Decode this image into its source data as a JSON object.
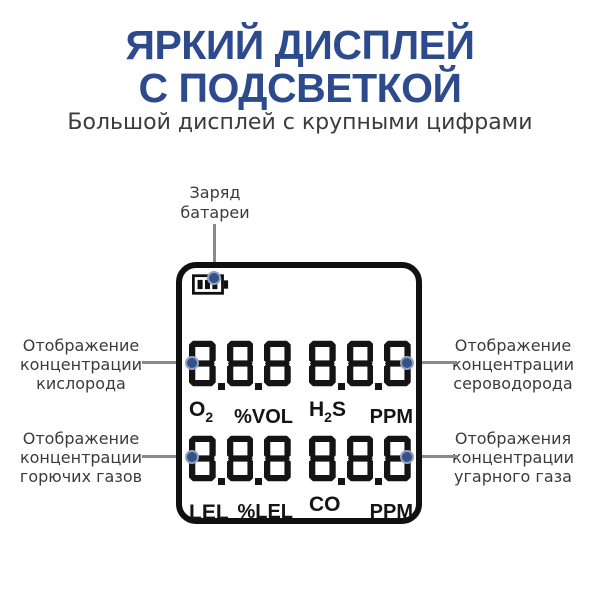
{
  "title": {
    "line1": "ЯРКИЙ ДИСПЛЕЙ",
    "line2": "С ПОДСВЕТКОЙ"
  },
  "subtitle": "Большой дисплей с крупными цифрами",
  "callouts": {
    "battery": [
      "Заряд",
      "батареи"
    ],
    "left_top": [
      "Отображение",
      "концентрации",
      "кислорода"
    ],
    "left_bottom": [
      "Отображение",
      "концентрации",
      "горючих газов"
    ],
    "right_top": [
      "Отображение",
      "концентрации",
      "сероводорода"
    ],
    "right_bottom": [
      "Отображения",
      "концентрации",
      "угарного газа"
    ]
  },
  "display": {
    "battery_icon": "battery-3-bars",
    "readouts": [
      {
        "id": "o2",
        "value": "8.8.8",
        "gas_pre": "O",
        "gas_sub": "2",
        "gas_post": "",
        "unit": "%VOL"
      },
      {
        "id": "h2s",
        "value": "8.8.8",
        "gas_pre": "H",
        "gas_sub": "2",
        "gas_post": "S",
        "unit": "PPM"
      },
      {
        "id": "lel",
        "value": "8.8.8",
        "gas_pre": "LEL",
        "gas_sub": "",
        "gas_post": "",
        "unit": "%LEL"
      },
      {
        "id": "co",
        "value": "8.8.8",
        "gas_pre": "CO",
        "gas_sub": "",
        "gas_post": "",
        "unit": "PPM"
      }
    ]
  },
  "colors": {
    "title_blue": "#2c4a8c",
    "label_gray": "#3b3b3b",
    "connector_gray": "#8a8a8a",
    "dot_blue": "#33518a",
    "dot_ring": "#96a2bd",
    "segment_black": "#141414",
    "panel_border": "#101010"
  }
}
